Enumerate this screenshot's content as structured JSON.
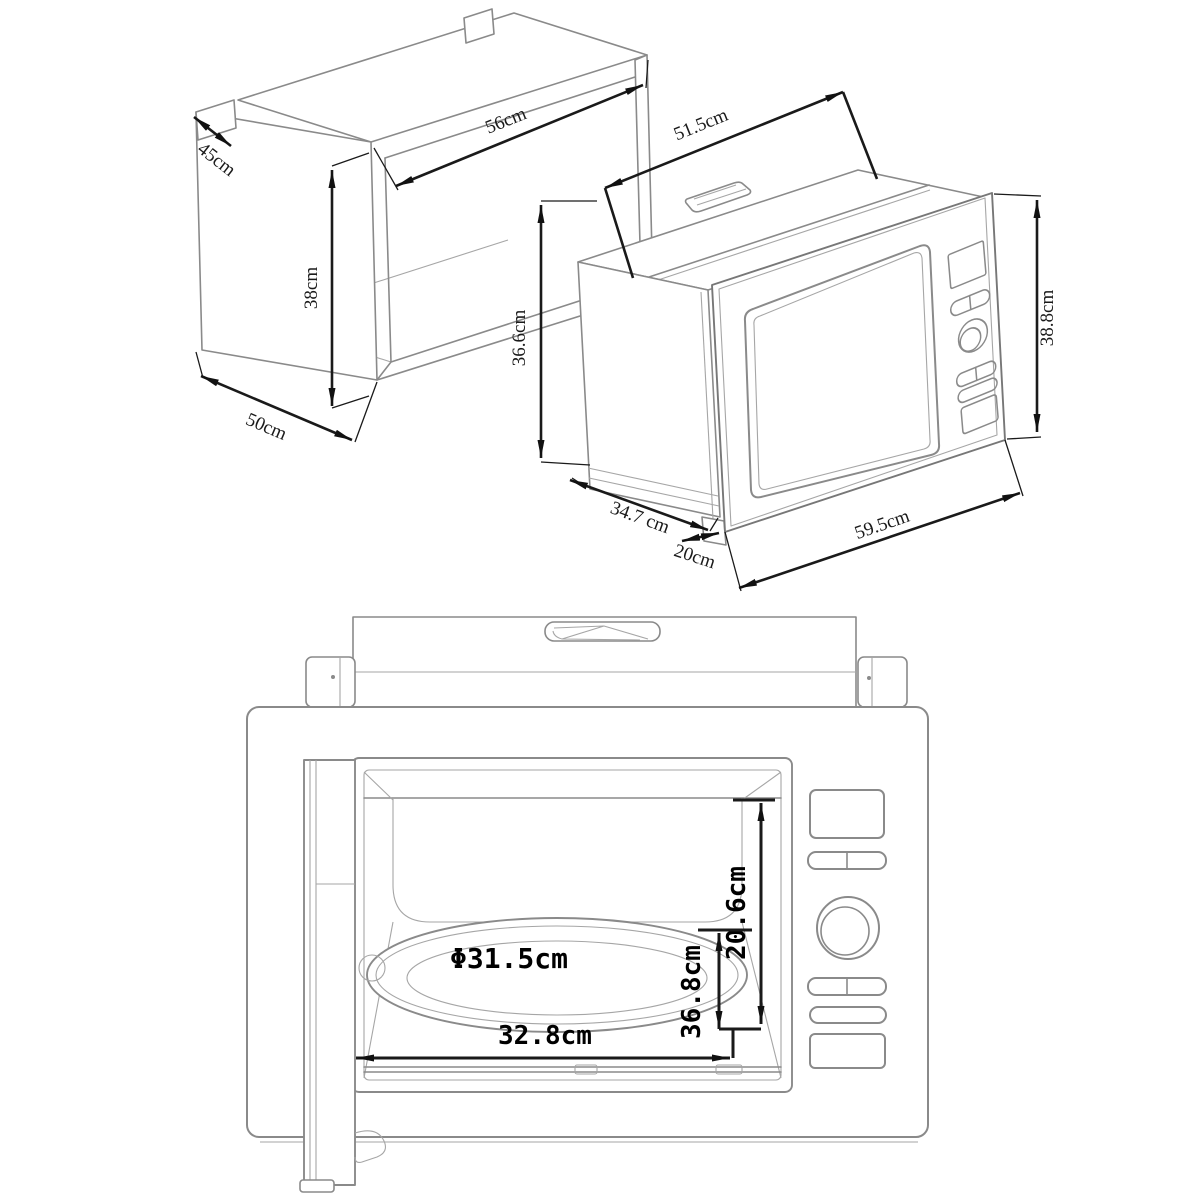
{
  "colors": {
    "background": "#ffffff",
    "object_line": "#8a8a8a",
    "dimension_line": "#1a1a1a",
    "label_color": "#1a1a1a"
  },
  "cabinet": {
    "dim_depth_top": "45cm",
    "dim_width": "56cm",
    "dim_height": "38cm",
    "dim_depth_bottom": "50cm"
  },
  "iso": {
    "dim_depth_top": "51.5cm",
    "dim_height_left": "36.6cm",
    "dim_depth_bottom": "34.7 cm",
    "dim_front_depth": "20cm",
    "dim_width": "59.5cm",
    "dim_height_right": "38.8cm"
  },
  "front": {
    "dim_turntable_diameter": "Φ31.5cm",
    "dim_cavity_width": "32.8cm",
    "dim_cavity_height": "36.8cm",
    "dim_opening_height": "20.6cm"
  }
}
